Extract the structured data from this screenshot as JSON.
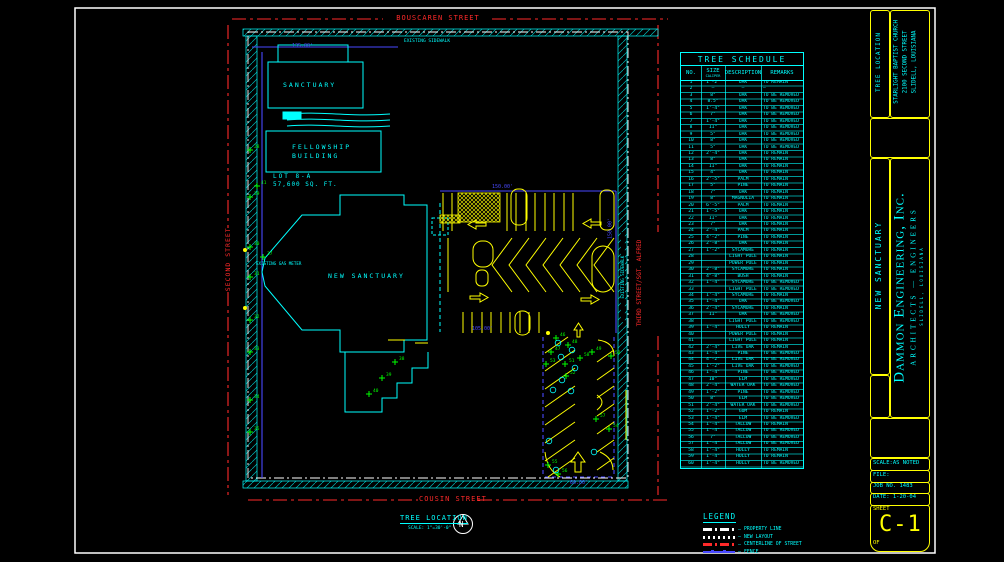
{
  "palette": {
    "cyan": "#00ffff",
    "yellow": "#ffff00",
    "red": "#ff2a2a",
    "blue": "#4949ff",
    "green": "#00ff00",
    "white": "#ffffff"
  },
  "streets": {
    "top": "BOUSCAREN STREET",
    "left": "SECOND STREET",
    "right": "THIRD STREET/SGT. ALFRED",
    "bottom": "COUSIN STREET"
  },
  "plan": {
    "sanctuary": "SANCTUARY",
    "fellowship_line1": "FELLOWSHIP",
    "fellowship_line2": "BUILDING",
    "lot_line1": "LOT 8-A",
    "lot_line2": "57,600 SQ. FT.",
    "new_sanctuary": "NEW SANCTUARY",
    "gas_meter": "EXISTING GAS METER",
    "sidewalk_top": "EXISTING SIDEWALK",
    "sidewalk_right": "EXISTING SIDEWALK",
    "dims": {
      "d_top_left": "135.00'",
      "d_top_right": "150.00'",
      "d_right": "150.00'",
      "d_mid": "105.00'",
      "d_bottom": "60.00'"
    }
  },
  "caption": {
    "title": "TREE LOCATION",
    "scale": "SCALE: 1\"=30'-0\"",
    "north": "N"
  },
  "legend": {
    "title": "LEGEND",
    "items": [
      {
        "label": "PROPERTY LINE",
        "style": "dashdot",
        "color": "#ffffff"
      },
      {
        "label": "NEW LAYOUT",
        "style": "dotted",
        "color": "#ffffff"
      },
      {
        "label": "CENTERLINE OF STREET",
        "style": "dashdot",
        "color": "#ff2a2a"
      },
      {
        "label": "FENCE",
        "style": "fence",
        "color": "#4949ff"
      }
    ]
  },
  "tree_schedule": {
    "title": "TREE SCHEDULE",
    "columns": [
      "NO.",
      "SIZE",
      "DESCRIPTION",
      "REMARKS"
    ],
    "size_sub": "CALIPER",
    "rows": [
      [
        "1",
        "1'-2\"",
        "OAK",
        "TO REMAIN"
      ],
      [
        "2",
        "—",
        "—",
        "—"
      ],
      [
        "3",
        "8\"",
        "OAK",
        "TO BE REMOVED"
      ],
      [
        "4",
        "8.5\"",
        "OAK",
        "TO BE REMOVED"
      ],
      [
        "5",
        "1'-4\"",
        "OAK",
        "TO BE REMOVED"
      ],
      [
        "6",
        "7\"",
        "OAK",
        "TO BE REMOVED"
      ],
      [
        "7",
        "1'-4\"",
        "OAK",
        "TO BE REMOVED"
      ],
      [
        "8",
        "11\"",
        "OAK",
        "TO BE REMOVED"
      ],
      [
        "9",
        "5\"",
        "OAK",
        "TO BE REMOVED"
      ],
      [
        "10",
        "8\"",
        "OAK",
        "TO BE REMOVED"
      ],
      [
        "11",
        "5\"",
        "OAK",
        "TO BE REMOVED"
      ],
      [
        "12",
        "2'-4\"",
        "OAK",
        "TO REMAIN"
      ],
      [
        "13",
        "8\"",
        "OAK",
        "TO REMAIN"
      ],
      [
        "14",
        "11\"",
        "OAK",
        "TO REMAIN"
      ],
      [
        "15",
        "4\"",
        "OAK",
        "TO REMAIN"
      ],
      [
        "16",
        "2'-5\"",
        "PALM",
        "TO REMAIN"
      ],
      [
        "17",
        "5\"",
        "PINE",
        "TO REMAIN"
      ],
      [
        "18",
        "7\"",
        "OAK",
        "TO REMAIN"
      ],
      [
        "19",
        "8\"",
        "MAGNOLIA",
        "TO REMAIN"
      ],
      [
        "20",
        "6'-5\"",
        "PALM",
        "TO REMAIN"
      ],
      [
        "21",
        "1'-5\"",
        "OAK",
        "TO REMAIN"
      ],
      [
        "22",
        "11\"",
        "OAK",
        "TO REMAIN"
      ],
      [
        "23",
        "7\"",
        "OAK",
        "TO REMAIN"
      ],
      [
        "24",
        "2'-4\"",
        "PALM",
        "TO REMAIN"
      ],
      [
        "25",
        "4'-2\"",
        "PINE",
        "TO REMAIN"
      ],
      [
        "26",
        "2'-8\"",
        "OAK",
        "TO REMAIN"
      ],
      [
        "27",
        "1'-2\"",
        "SYCAMORE",
        "TO REMAIN"
      ],
      [
        "28",
        "",
        "LIGHT POLE",
        "TO REMAIN"
      ],
      [
        "29",
        "",
        "POWER POLE",
        "TO REMAIN"
      ],
      [
        "30",
        "2'-8\"",
        "SYCAMORE",
        "TO REMAIN"
      ],
      [
        "31",
        "4\"-8\"",
        "BUSH",
        "TO REMAIN"
      ],
      [
        "32",
        "1'-4\"",
        "SYCAMORE",
        "TO BE REMOVED"
      ],
      [
        "33",
        "",
        "LIGHT POLE",
        "TO BE REMOVED"
      ],
      [
        "34",
        "1'-4\"",
        "SYCAMORE",
        "TO REMAIN"
      ],
      [
        "35",
        "1'-4\"",
        "OAK",
        "TO BE REMOVED"
      ],
      [
        "36",
        "2'-4\"",
        "SYCAMORE",
        "TO REMAIN"
      ],
      [
        "37",
        "11\"",
        "OAK",
        "TO BE REMOVED"
      ],
      [
        "38",
        "",
        "LIGHT POLE",
        "TO BE REMOVED"
      ],
      [
        "39",
        "1'-4\"",
        "HOLLY",
        "TO REMAIN"
      ],
      [
        "40",
        "",
        "POWER POLE",
        "TO REMAIN"
      ],
      [
        "41",
        "",
        "LIGHT POLE",
        "TO REMAIN"
      ],
      [
        "42",
        "2'-4\"",
        "LIVE OAK",
        "TO REMAIN"
      ],
      [
        "43",
        "1'-4\"",
        "PINE",
        "TO BE REMOVED"
      ],
      [
        "44",
        "4'-2\"",
        "LIVE OAK",
        "TO BE REMOVED"
      ],
      [
        "45",
        "1'-2\"",
        "LIVE OAK",
        "TO BE REMOVED"
      ],
      [
        "46",
        "1'-4\"",
        "PINE",
        "TO BE REMOVED"
      ],
      [
        "47",
        "10\"",
        "ELM",
        "TO BE REMOVED"
      ],
      [
        "48",
        "2'-4\"",
        "WATER OAK",
        "TO BE REMOVED"
      ],
      [
        "49",
        "1'-2\"",
        "PINE",
        "TO BE REMOVED"
      ],
      [
        "50",
        "8\"",
        "ELM",
        "TO BE REMOVED"
      ],
      [
        "51",
        "2'-4\"",
        "WATER OAK",
        "TO BE REMOVED"
      ],
      [
        "52",
        "1'-2\"",
        "GUM",
        "TO REMAIN"
      ],
      [
        "53",
        "1'-4\"",
        "ELM",
        "TO BE REMOVED"
      ],
      [
        "54",
        "1'-4\"",
        "TALLOW",
        "TO REMAIN"
      ],
      [
        "55",
        "1'-4\"",
        "TALLOW",
        "TO BE REMOVED"
      ],
      [
        "56",
        "7\"",
        "TALLOW",
        "TO BE REMOVED"
      ],
      [
        "57",
        "1'-4\"",
        "TALLOW",
        "TO BE REMOVED"
      ],
      [
        "58",
        "1'-4\"",
        "HOLLY",
        "TO REMAIN"
      ],
      [
        "59",
        "1'-4\"",
        "HOLLY",
        "TO REMAIN"
      ],
      [
        "60",
        "1'-4\"",
        "HOLLY",
        "TO BE REMOVED"
      ]
    ]
  },
  "titleblock": {
    "project": "TREE LOCATION",
    "client_line1": "STARLIGHT BAPTIST CHURCH",
    "client_line2": "2100 SECOND STREET",
    "client_line3": "SLIDELL, LOUISIANA",
    "sheet_title": "NEW SANCTUARY",
    "firm": "Dammon Engineering, Inc.",
    "firm_sub": "ARCHITECTS — ENGINEERS",
    "firm_addr": "SLIDELL, LOUISIANA",
    "scale": "SCALE:AS NOTED",
    "file": "FILE:",
    "job": "JOB NO. 1483",
    "date": "DATE: 1-20-04",
    "sheet_label": "SHEET",
    "sheet_no": "C-1",
    "of": "OF"
  },
  "markers": {
    "green": [
      {
        "x": 250,
        "y": 150,
        "n": "28"
      },
      {
        "x": 250,
        "y": 197,
        "n": "29"
      },
      {
        "x": 250,
        "y": 247,
        "n": "30"
      },
      {
        "x": 250,
        "y": 277,
        "n": "31"
      },
      {
        "x": 250,
        "y": 320,
        "n": "32"
      },
      {
        "x": 250,
        "y": 352,
        "n": "33"
      },
      {
        "x": 250,
        "y": 400,
        "n": "34"
      },
      {
        "x": 250,
        "y": 432,
        "n": "35"
      },
      {
        "x": 263,
        "y": 257,
        "n": "37"
      },
      {
        "x": 257,
        "y": 186,
        "n": "41"
      },
      {
        "x": 395,
        "y": 362,
        "n": "38"
      },
      {
        "x": 382,
        "y": 378,
        "n": "39"
      },
      {
        "x": 369,
        "y": 394,
        "n": "40"
      },
      {
        "x": 556,
        "y": 338,
        "n": "46"
      },
      {
        "x": 551,
        "y": 352,
        "n": "47"
      },
      {
        "x": 568,
        "y": 345,
        "n": "48"
      },
      {
        "x": 592,
        "y": 352,
        "n": "49"
      },
      {
        "x": 611,
        "y": 356,
        "n": "50"
      },
      {
        "x": 565,
        "y": 364,
        "n": "51"
      },
      {
        "x": 566,
        "y": 376,
        "n": "52"
      },
      {
        "x": 546,
        "y": 364,
        "n": "53"
      },
      {
        "x": 609,
        "y": 429,
        "n": "54"
      },
      {
        "x": 548,
        "y": 465,
        "n": "55"
      },
      {
        "x": 558,
        "y": 474,
        "n": "56"
      },
      {
        "x": 596,
        "y": 419,
        "n": "57"
      },
      {
        "x": 580,
        "y": 358,
        "n": "58"
      }
    ],
    "trees_cyan": [
      {
        "x": 558,
        "y": 343
      },
      {
        "x": 572,
        "y": 350
      },
      {
        "x": 561,
        "y": 357
      },
      {
        "x": 575,
        "y": 368
      },
      {
        "x": 562,
        "y": 380
      },
      {
        "x": 553,
        "y": 390
      },
      {
        "x": 571,
        "y": 391
      },
      {
        "x": 549,
        "y": 441
      },
      {
        "x": 556,
        "y": 470
      },
      {
        "x": 594,
        "y": 452
      }
    ],
    "dots_yellow": [
      {
        "x": 245,
        "y": 250
      },
      {
        "x": 245,
        "y": 308
      },
      {
        "x": 548,
        "y": 333
      }
    ]
  }
}
